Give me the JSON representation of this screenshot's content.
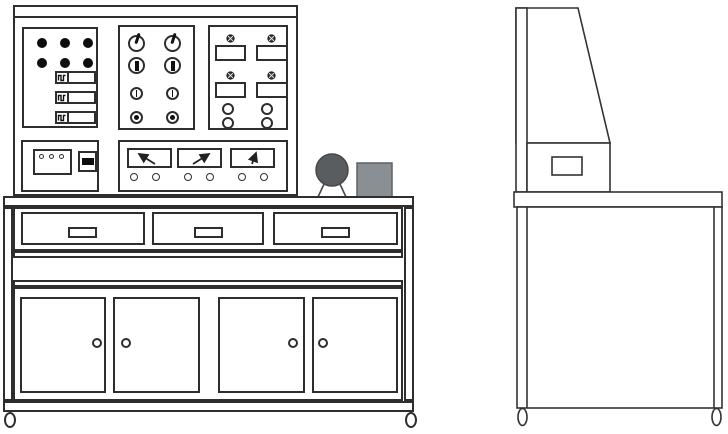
{
  "meta": {
    "views": [
      "front",
      "side"
    ],
    "drawing_style": "black-outline technical line drawing"
  },
  "colors": {
    "line": "#2e2e2e",
    "background": "#ffffff",
    "indicator_light": "#0d0d0d",
    "motor_fill": "#595d60",
    "motor_stroke": "#46484a",
    "box_fill": "#8a8f93",
    "box_stroke": "#5e6266"
  },
  "front_view": {
    "control_console": {
      "indicator_panel": {
        "indicator_lights": 6,
        "breaker_switches": 3
      },
      "knob_panel": {
        "columns": 2,
        "row_types": [
          "pointer-knob",
          "bar-knob",
          "line-knob",
          "dot-knob"
        ]
      },
      "display_panel": {
        "meter_windows": 4,
        "window_lamps": 4,
        "lamp_symbol": "circled-cross",
        "terminals": 4
      },
      "power_panel": {
        "socket_pins": 3,
        "rocker_switches": 1
      },
      "meter_panel": {
        "analog_meters": 3,
        "needle_directions": [
          "up-left",
          "up-right",
          "up"
        ],
        "terminals": 6
      }
    },
    "worktop_devices": {
      "motor": "three-phase-motor",
      "module": "control-box"
    },
    "bench": {
      "drawers": 3,
      "drawer_handles": 3,
      "cabinet_doors": 4,
      "door_knobs": 4,
      "casters": 2
    }
  },
  "side_view": {
    "console_profile": "sloped-trapezoid",
    "handle_cutouts": 1,
    "casters": 2
  }
}
